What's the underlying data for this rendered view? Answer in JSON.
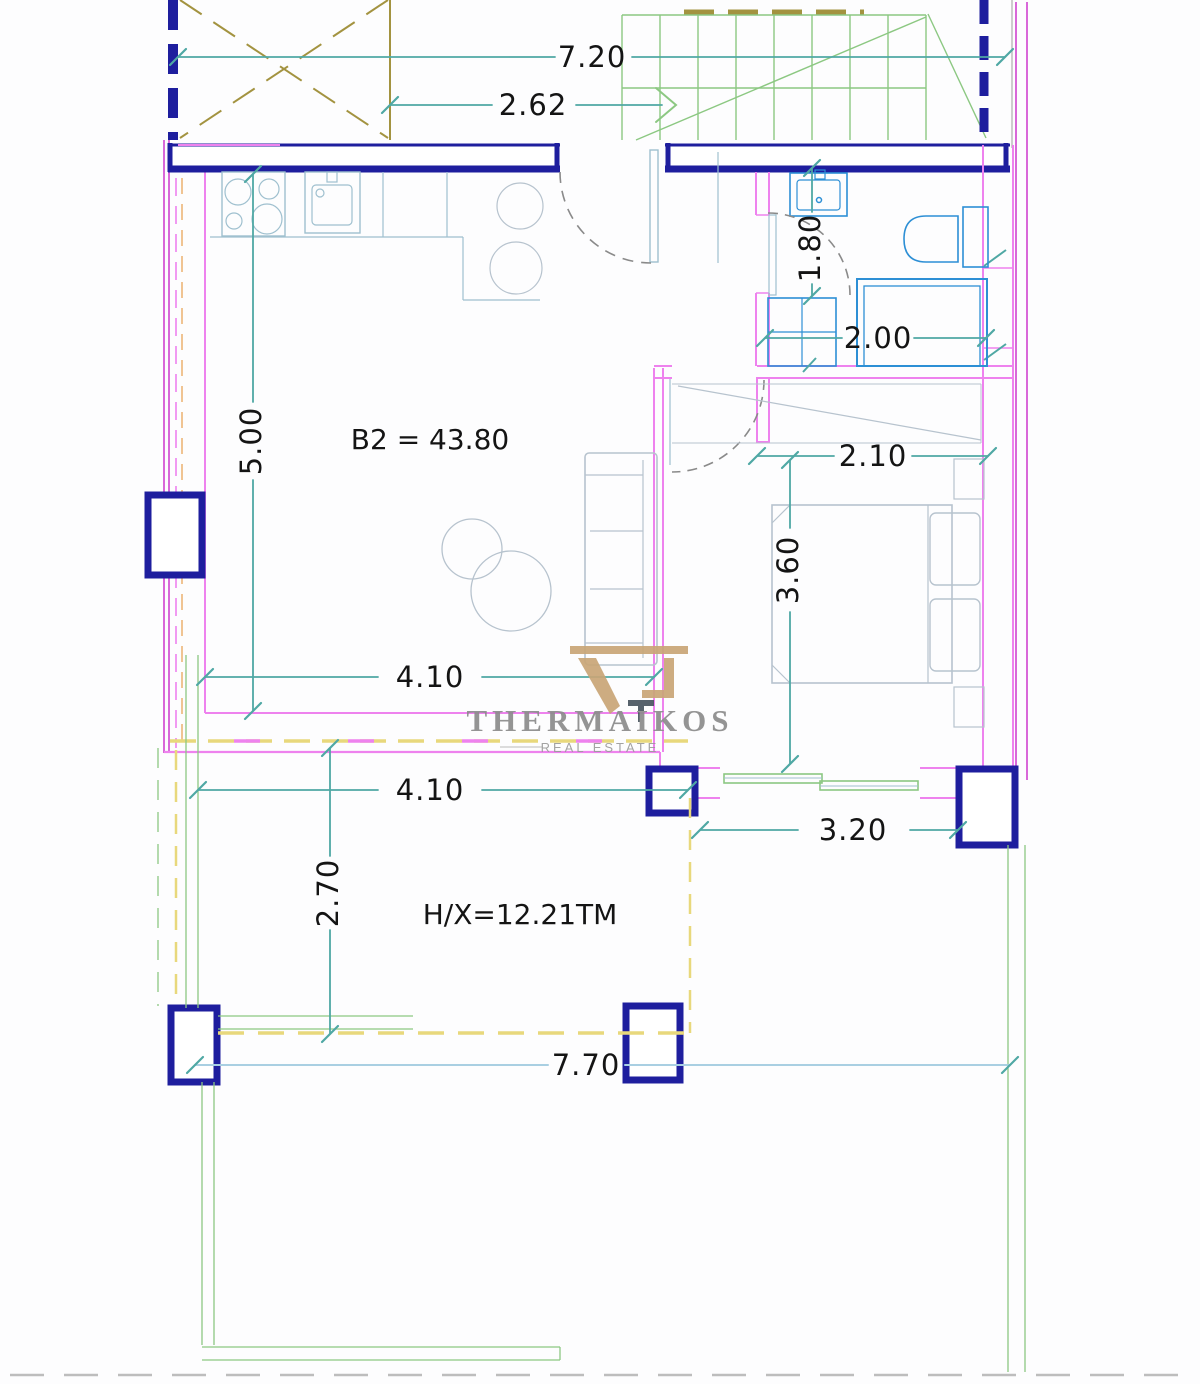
{
  "palette": {
    "navy": "#1e1e9e",
    "pink": "#ee82ee",
    "pinkDark": "#d557d5",
    "teal": "#4fa8a4",
    "lightBlue": "#a9cfe2",
    "green": "#8cc882",
    "olive": "#a39340",
    "yellow": "#e8d87c",
    "orange": "#f0c493",
    "fixture": "#2d8fd5",
    "furniture": "#b7c3ce",
    "kitchen": "#9fc0cf",
    "ink": "#141414",
    "logoGray": "#8c8c8c",
    "logoTan": "#c9a677",
    "logoDark": "#4a5560",
    "grayDash": "#bdbdbd",
    "doorArc": "#8a8a8a"
  },
  "plan": {
    "unit_label": "B2 = 43.80",
    "terrace_label": "H/X=12.21TM"
  },
  "dimensions": {
    "overall_width": "7.20",
    "stair_width": "2.62",
    "living_depth": "5.00",
    "bath_entry_width": "1.80",
    "shower_width": "2.00",
    "closet_width": "2.10",
    "bedroom_depth": "3.60",
    "living_width": "4.10",
    "terrace_width": "4.10",
    "terrace_depth": "2.70",
    "bedroom_window_width": "3.20",
    "terrace_total_width": "7.70"
  },
  "branding": {
    "name": "THERMAIKOS",
    "tagline": "REAL ESTATE"
  }
}
